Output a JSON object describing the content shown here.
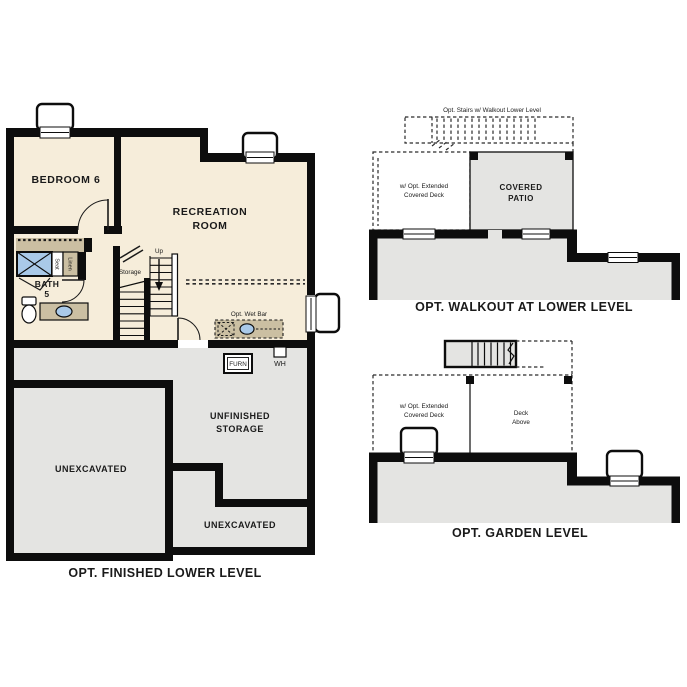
{
  "palette": {
    "wall": "#0d0d0d",
    "finished_floor": "#f6edda",
    "unfinished_floor": "#e4e4e2",
    "counter_tan": "#cbbfa2",
    "fixture_blue": "#a9c9e8",
    "line": "#2a2a2a"
  },
  "finished_lower": {
    "title": "OPT. FINISHED LOWER LEVEL",
    "bedroom": "BEDROOM 6",
    "recreation": {
      "line1": "RECREATION",
      "line2": "ROOM"
    },
    "bath": {
      "line1": "BATH",
      "line2": "5"
    },
    "seat": "Seat",
    "linen": "Linen",
    "storage_closet": "Storage",
    "up": "Up",
    "wet_bar": "Opt. Wet Bar",
    "furnace": "FURN",
    "water_heater": "WH",
    "unfinished": {
      "line1": "UNFINISHED",
      "line2": "STORAGE"
    },
    "unexcavated_left": "UNEXCAVATED",
    "unexcavated_bottom": "UNEXCAVATED"
  },
  "walkout": {
    "title": "OPT. WALKOUT AT LOWER LEVEL",
    "stairs_note": "Opt. Stairs w/ Walkout Lower Level",
    "deck": {
      "line1": "w/ Opt. Extended",
      "line2": "Covered Deck"
    },
    "patio": {
      "line1": "COVERED",
      "line2": "PATIO"
    }
  },
  "garden": {
    "title": "OPT. GARDEN LEVEL",
    "deck": {
      "line1": "w/ Opt. Extended",
      "line2": "Covered Deck"
    },
    "deck_above": {
      "line1": "Deck",
      "line2": "Above"
    }
  }
}
